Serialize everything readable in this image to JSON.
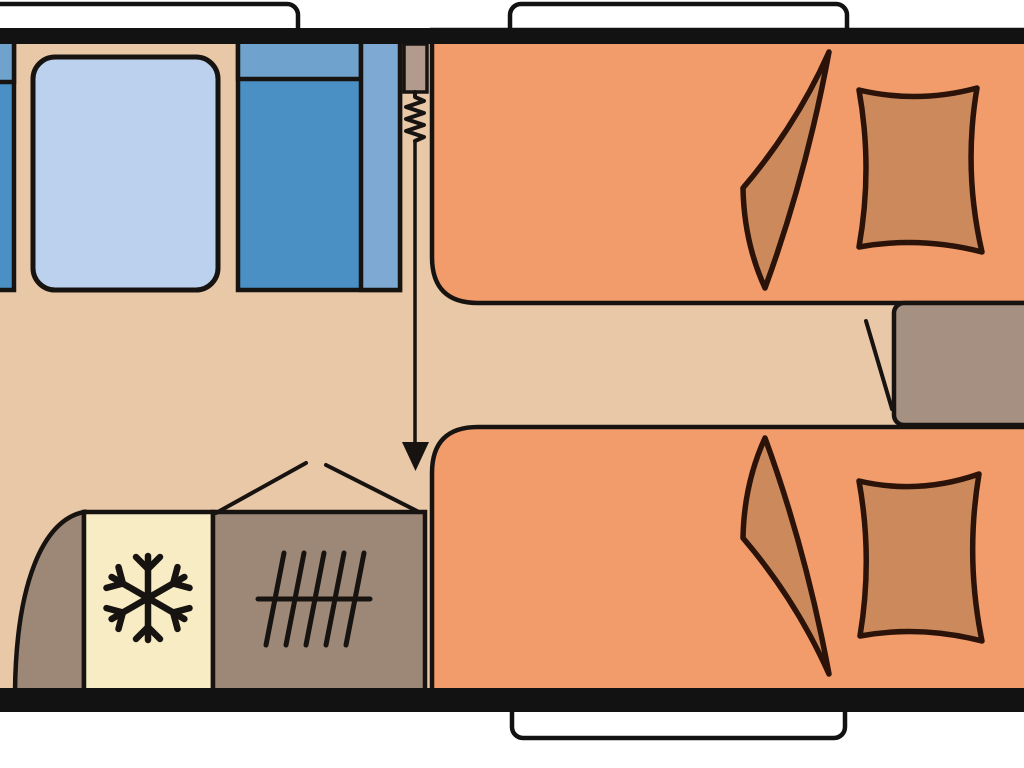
{
  "meta": {
    "type": "caravan-floorplan",
    "description": "Top-down floor plan drawing of a caravan interior: front dinette with table and blue benches, entrance door with spring symbol and entry arrow, kitchen block with wardrobe, fridge (snowflake) and heater (hatched grille), and two single beds with pillows and folded blankets separated by a bedside chest. Plan is cropped at left and right image edges.",
    "visible_text": ""
  },
  "colors": {
    "background": "#ffffff",
    "wall": "#121212",
    "outline": "#171310",
    "floor": "#e9c8a8",
    "window": "#ffffff",
    "table": "#bbd1ed",
    "bench": "#4a90c4",
    "bench_light": "#6fa3cd",
    "bench_strip": "#7ea9d2",
    "bed": "#f29b6b",
    "bedding": "#cc8a5c",
    "bedding_outline": "#2b1309",
    "fridge": "#f7ecc4",
    "cabinet": "#9d8878",
    "bedside_chest": "#a69081",
    "door": "#b29b8c"
  },
  "elements": {
    "walls": {
      "top": "full-width black wall",
      "bottom": "full-width black wall"
    },
    "windows": [
      {
        "name": "window-front-left",
        "position": "top wall, left, cut off at image edge"
      },
      {
        "name": "window-top-right",
        "position": "top wall, above head end of top bed"
      },
      {
        "name": "window-bottom",
        "position": "bottom wall, below beds"
      }
    ],
    "dinette": {
      "bench_left": "blue bench, cut off at left image edge",
      "table": "light blue rounded rectangle table",
      "bench_right": "blue bench with light backrest band and side strip"
    },
    "entrance": {
      "door": "door leaf above spring symbol",
      "spring": "compressed spring / zigzag symbol",
      "arrow": "entry direction arrow pointing down into the corridor"
    },
    "kitchen": {
      "wardrobe": "curved-front corner unit",
      "fridge": "cream unit marked with snowflake symbol",
      "heater": "grey unit marked with hatched grille symbol",
      "overhead": "peaked roof-line marks above the unit"
    },
    "bedroom": {
      "bed_top": "single bed, upper right, rounded inner corner",
      "bed_bottom": "single bed, lower right, rounded inner corner",
      "bedding": "each bed has a folded blanket sail-shape and a cushion-shaped pillow",
      "bedside_chest": "chest between the two beds at right edge, with open-flap line"
    }
  }
}
